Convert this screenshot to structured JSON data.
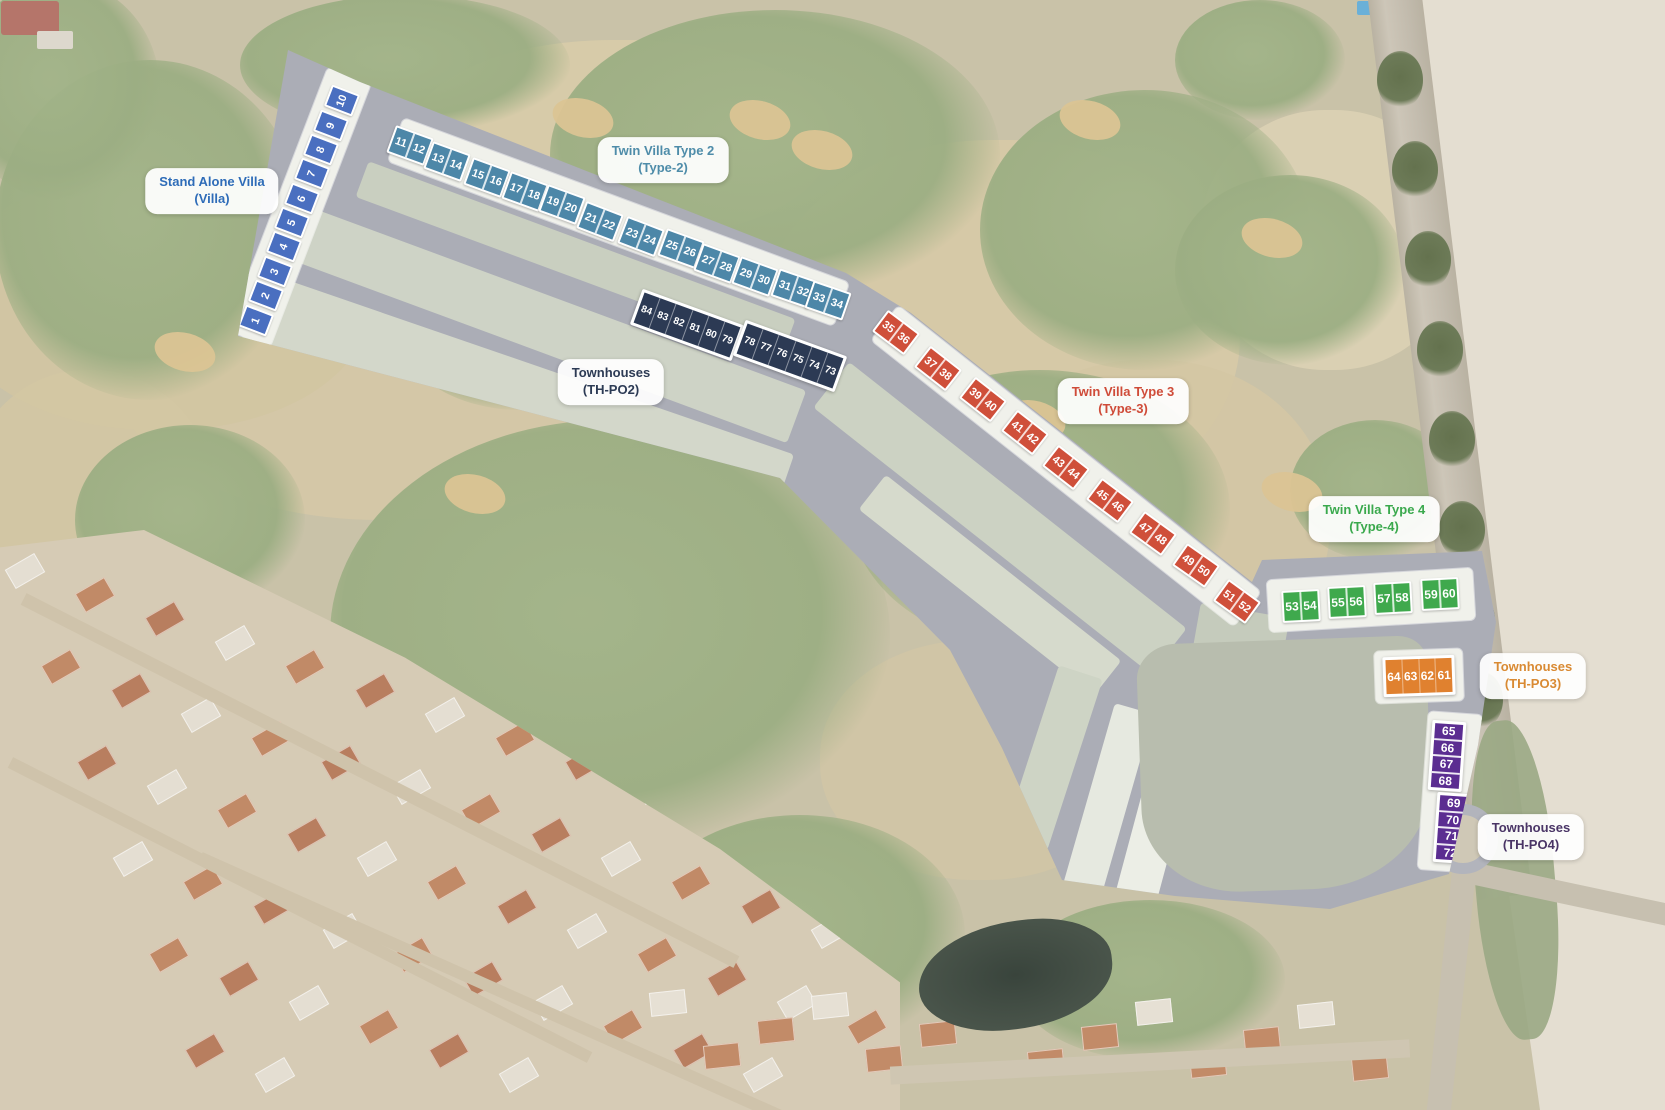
{
  "scene": {
    "type": "masterplan-over-satellite",
    "description": "Golf resort residential masterplan with numbered plots 1-84"
  },
  "plot_groups": [
    {
      "id": "stand-alone-villa",
      "kind": "single",
      "chip_color": "#4a6fc0",
      "chip_w": 30,
      "chip_h": 23,
      "font": 11,
      "num_rot": -90,
      "label": {
        "line1": "Stand Alone Villa",
        "line2": "(Villa)",
        "x": 212,
        "y": 191,
        "color": "#2e6cb8"
      },
      "plots": [
        {
          "n": "1",
          "x": 256,
          "y": 320,
          "r": 21
        },
        {
          "n": "2",
          "x": 266,
          "y": 295,
          "r": 21
        },
        {
          "n": "3",
          "x": 275,
          "y": 271,
          "r": 21
        },
        {
          "n": "4",
          "x": 284,
          "y": 246,
          "r": 21
        },
        {
          "n": "5",
          "x": 292,
          "y": 222,
          "r": 21
        },
        {
          "n": "6",
          "x": 302,
          "y": 198,
          "r": 21
        },
        {
          "n": "7",
          "x": 312,
          "y": 173,
          "r": 21
        },
        {
          "n": "8",
          "x": 321,
          "y": 149,
          "r": 21
        },
        {
          "n": "9",
          "x": 331,
          "y": 125,
          "r": 21
        },
        {
          "n": "10",
          "x": 342,
          "y": 100,
          "r": 21
        }
      ]
    },
    {
      "id": "twin-villa-type-2",
      "kind": "pair",
      "chip_color": "#4d87a8",
      "chip_w": 40,
      "chip_h": 29,
      "font": 11,
      "label": {
        "line1": "Twin Villa Type 2",
        "line2": "(Type-2)",
        "x": 663,
        "y": 160,
        "color": "#4e8ca9"
      },
      "plots": [
        {
          "a": "11",
          "b": "12",
          "x": 410,
          "y": 145,
          "r": 20
        },
        {
          "a": "13",
          "b": "14",
          "x": 447,
          "y": 161,
          "r": 20
        },
        {
          "a": "15",
          "b": "16",
          "x": 487,
          "y": 177,
          "r": 20
        },
        {
          "a": "17",
          "b": "18",
          "x": 525,
          "y": 191,
          "r": 20
        },
        {
          "a": "19",
          "b": "20",
          "x": 562,
          "y": 204,
          "r": 20
        },
        {
          "a": "21",
          "b": "22",
          "x": 600,
          "y": 221,
          "r": 21
        },
        {
          "a": "23",
          "b": "24",
          "x": 641,
          "y": 236,
          "r": 21
        },
        {
          "a": "25",
          "b": "26",
          "x": 681,
          "y": 248,
          "r": 20
        },
        {
          "a": "27",
          "b": "28",
          "x": 717,
          "y": 263,
          "r": 20
        },
        {
          "a": "29",
          "b": "30",
          "x": 755,
          "y": 276,
          "r": 20
        },
        {
          "a": "31",
          "b": "32",
          "x": 794,
          "y": 288,
          "r": 19
        },
        {
          "a": "33",
          "b": "34",
          "x": 828,
          "y": 300,
          "r": 19
        }
      ]
    },
    {
      "id": "townhouses-th-po2",
      "kind": "row-block",
      "chip_color": "#2c3a54",
      "block_w": 108,
      "block_h": 38,
      "font": 10,
      "label": {
        "line1": "Townhouses",
        "line2": "(TH-PO2)",
        "x": 611,
        "y": 382,
        "color": "#2c3a54"
      },
      "blocks": [
        {
          "numbers": [
            "84",
            "83",
            "82",
            "81",
            "80",
            "79"
          ],
          "x": 687,
          "y": 325,
          "r": 20
        },
        {
          "numbers": [
            "78",
            "77",
            "76",
            "75",
            "74",
            "73"
          ],
          "x": 790,
          "y": 356,
          "r": 20
        }
      ]
    },
    {
      "id": "twin-villa-type-3",
      "kind": "pair",
      "chip_color": "#cf4f3a",
      "chip_w": 40,
      "chip_h": 27,
      "font": 11,
      "label": {
        "line1": "Twin Villa Type 3",
        "line2": "(Type-3)",
        "x": 1123,
        "y": 401,
        "color": "#cf4b38"
      },
      "plots": [
        {
          "a": "35",
          "b": "36",
          "x": 896,
          "y": 332,
          "r": 37
        },
        {
          "a": "37",
          "b": "38",
          "x": 938,
          "y": 368,
          "r": 38
        },
        {
          "a": "39",
          "b": "40",
          "x": 983,
          "y": 399,
          "r": 38
        },
        {
          "a": "41",
          "b": "42",
          "x": 1025,
          "y": 432,
          "r": 38
        },
        {
          "a": "43",
          "b": "44",
          "x": 1066,
          "y": 467,
          "r": 38
        },
        {
          "a": "45",
          "b": "46",
          "x": 1110,
          "y": 500,
          "r": 37
        },
        {
          "a": "47",
          "b": "48",
          "x": 1153,
          "y": 533,
          "r": 36
        },
        {
          "a": "49",
          "b": "50",
          "x": 1196,
          "y": 565,
          "r": 35
        },
        {
          "a": "51",
          "b": "52",
          "x": 1237,
          "y": 601,
          "r": 36
        }
      ]
    },
    {
      "id": "twin-villa-type-4",
      "kind": "pair",
      "chip_color": "#3fa94d",
      "chip_w": 38,
      "chip_h": 32,
      "font": 12,
      "label": {
        "line1": "Twin Villa Type 4",
        "line2": "(Type-4)",
        "x": 1374,
        "y": 519,
        "color": "#3aa94d"
      },
      "plots": [
        {
          "a": "53",
          "b": "54",
          "x": 1301,
          "y": 606,
          "r": -3
        },
        {
          "a": "55",
          "b": "56",
          "x": 1347,
          "y": 602,
          "r": -3
        },
        {
          "a": "57",
          "b": "58",
          "x": 1393,
          "y": 598,
          "r": -3
        },
        {
          "a": "59",
          "b": "60",
          "x": 1440,
          "y": 594,
          "r": -3
        }
      ]
    },
    {
      "id": "townhouses-th-po3",
      "kind": "row-block",
      "chip_color": "#e0812f",
      "block_w": 72,
      "block_h": 40,
      "font": 12,
      "label": {
        "line1": "Townhouses",
        "line2": "(TH-PO3)",
        "x": 1533,
        "y": 676,
        "color": "#d98a33"
      },
      "blocks": [
        {
          "numbers": [
            "64",
            "63",
            "62",
            "61"
          ],
          "x": 1419,
          "y": 676,
          "r": -2
        }
      ]
    },
    {
      "id": "townhouses-th-po4",
      "kind": "col-block",
      "chip_color": "#5b2d91",
      "block_w": 34,
      "block_h": 70,
      "font": 12,
      "label": {
        "line1": "Townhouses",
        "line2": "(TH-PO4)",
        "x": 1531,
        "y": 837,
        "color": "#4a3566"
      },
      "blocks": [
        {
          "numbers": [
            "65",
            "66",
            "67",
            "68"
          ],
          "x": 1447,
          "y": 756,
          "r": 4
        },
        {
          "numbers": [
            "69",
            "70",
            "71",
            "72"
          ],
          "x": 1452,
          "y": 828,
          "r": 4
        }
      ]
    }
  ]
}
